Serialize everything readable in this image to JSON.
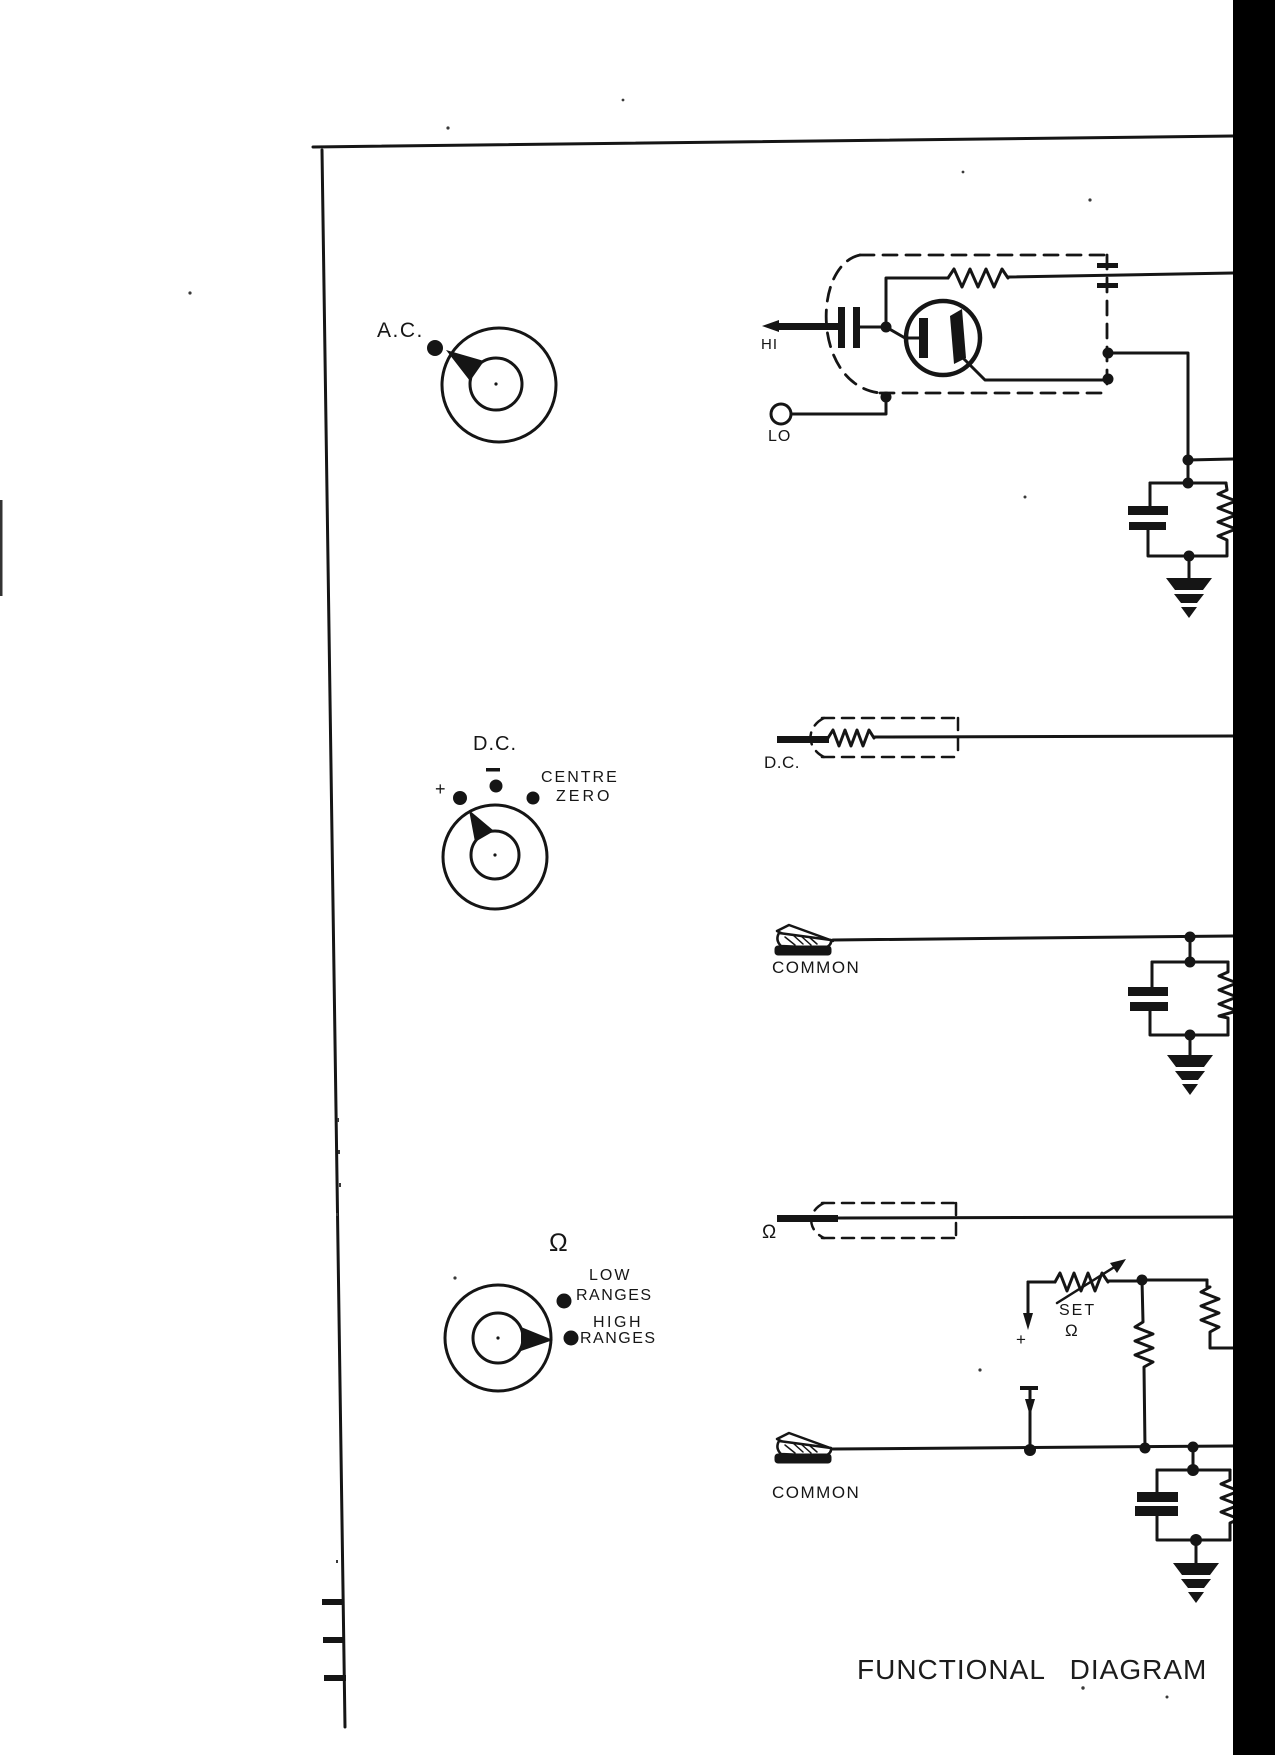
{
  "page": {
    "caption": "FUNCTIONAL DIAGRAM OF"
  },
  "knobs": {
    "ac": {
      "label": "A.C."
    },
    "dc": {
      "label": "D.C.",
      "plus": "+",
      "centre": "CENTRE",
      "zero": "ZERO"
    },
    "ohms": {
      "symbol": "Ω",
      "low": "LOW",
      "low_ranges": "RANGES",
      "high": "HIGH",
      "high_ranges": "RANGES"
    }
  },
  "leads": {
    "hi": "HI",
    "lo": "LO",
    "dc_probe": "D.C.",
    "ohms_probe": "Ω",
    "common_upper": "COMMON",
    "common_lower": "COMMON"
  },
  "ohms_adjust": {
    "set": "SET",
    "omega": "Ω",
    "battery_plus": "+"
  },
  "colors": {
    "ink": "#151515",
    "paper": "#ffffff",
    "gutter": "#000000"
  }
}
